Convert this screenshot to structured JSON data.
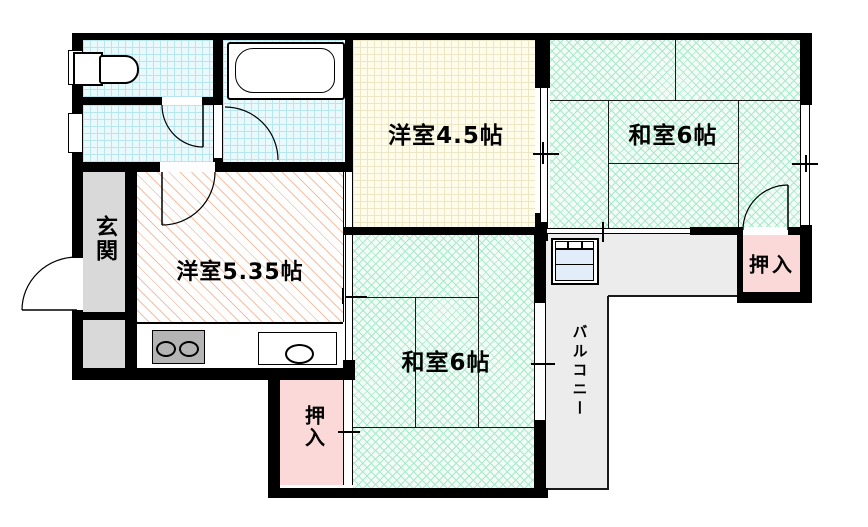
{
  "document": {
    "type": "apartment-floor-plan"
  },
  "rooms": {
    "western_room_45": {
      "label": "洋室4.5帖"
    },
    "japanese_room_6_top": {
      "label": "和室6帖"
    },
    "japanese_room_6_bottom": {
      "label": "和室6帖"
    },
    "western_room_535": {
      "label": "洋室5.35帖"
    },
    "entrance": {
      "label": "玄関"
    },
    "closet_top": {
      "label": "押入"
    },
    "closet_bottom": {
      "label": "押入"
    },
    "balcony": {
      "label": "バルコニー"
    }
  },
  "fixtures": {
    "toilet": "toilet-icon",
    "bathtub": "bathtub-icon",
    "stove": "stove-two-burner-icon",
    "sink": "kitchen-sink-icon",
    "ac_unit": "air-conditioner-unit-icon"
  },
  "colors": {
    "wall": "#000000",
    "tatami_green": "#a9e9ca",
    "room_yellow": "#fffce9",
    "water_cyan": "#b8e6ef",
    "closet_pink": "#fbd9d9",
    "entrance_gray": "#d9d9d9",
    "balcony_gray": "#ececec",
    "hatch_orange": "#f3c0a6"
  }
}
